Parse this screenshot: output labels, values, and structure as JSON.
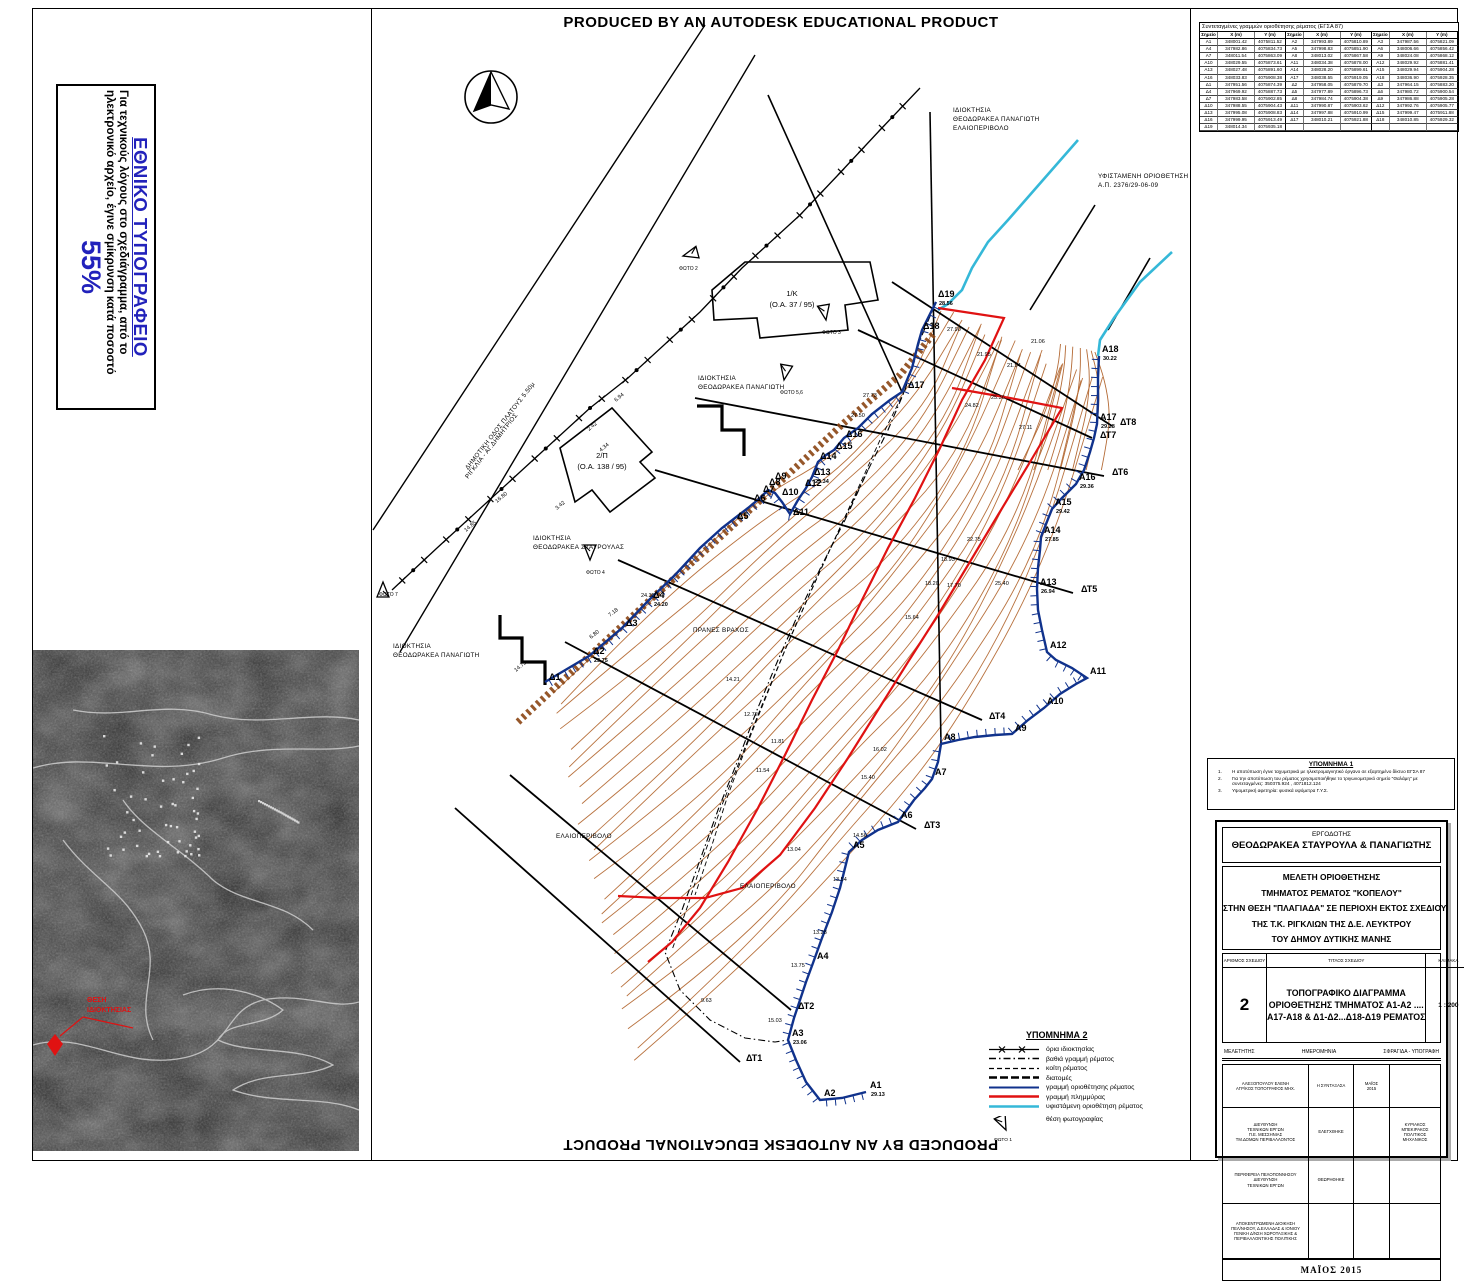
{
  "banner": {
    "text": "PRODUCED BY AN AUTODESK EDUCATIONAL PRODUCT"
  },
  "disclaimer": {
    "title": "ΕΘΝΙΚΟ ΤΥΠΟΓΡΑΦΕΙΟ",
    "body": "Για τεχνικούς λόγους στο σχεδιάγραμμα, από το ηλεκτρονικό αρχείο, έγινε σμίκρυνση κατά ποσοστό",
    "percent": "55%"
  },
  "north": {
    "label": "Β"
  },
  "aerial": {
    "label1": "ΘΕΣΗ",
    "label2": "ΙΔΙΟΚΤΗΣΙΑΣ"
  },
  "coords_table": {
    "title": "Συντεταγμένες γραμμών οριοθέτησης ρέματος (ΕΓΣΑ 87)",
    "headers": [
      "Σημείο",
      "X (m)",
      "Y (m)",
      "Σημείο",
      "X (m)",
      "Y (m)",
      "Σημείο",
      "X (m)",
      "Y (m)"
    ],
    "rows": [
      [
        "Α1",
        "348001.42",
        "4075811.52",
        "Α2",
        "347993.89",
        "4075810.89",
        "Α3",
        "347987.56",
        "4075821.09"
      ],
      [
        "Α4",
        "347982.86",
        "4075834.73",
        "Α5",
        "347998.83",
        "4075851.90",
        "Α6",
        "348006.66",
        "4075856.42"
      ],
      [
        "Α7",
        "348011.54",
        "4075863.09",
        "Α8",
        "348013.02",
        "4075867.58",
        "Α9",
        "348024.08",
        "4075868.12"
      ],
      [
        "Α10",
        "348029.55",
        "4075873.61",
        "Α11",
        "348034.38",
        "4075878.00",
        "Α12",
        "348029.92",
        "4075881.41"
      ],
      [
        "Α13",
        "348027.48",
        "4075891.60",
        "Α14",
        "348028.20",
        "4075899.61",
        "Α15",
        "348029.94",
        "4075904.28"
      ],
      [
        "Α16",
        "348033.83",
        "4075908.38",
        "Α17",
        "348038.55",
        "4075919.05",
        "Α18",
        "348036.90",
        "4075928.35"
      ],
      [
        "Δ1",
        "347951.56",
        "4075874.39",
        "Δ2",
        "347958.05",
        "4075879.70",
        "Δ3",
        "347964.15",
        "4075883.20"
      ],
      [
        "Δ4",
        "347969.92",
        "4075887.73",
        "Δ5",
        "347977.89",
        "4075896.73",
        "Δ6",
        "347980.72",
        "4075900.54"
      ],
      [
        "Δ7",
        "347983.58",
        "4075902.85",
        "Δ8",
        "347984.74",
        "4075904.38",
        "Δ9",
        "347986.88",
        "4075905.28"
      ],
      [
        "Δ10",
        "347988.55",
        "4075904.43",
        "Δ11",
        "347990.87",
        "4075903.62",
        "Δ12",
        "347992.76",
        "4075905.77"
      ],
      [
        "Δ13",
        "347995.08",
        "4075908.83",
        "Δ14",
        "347997.88",
        "4075910.99",
        "Δ15",
        "347999.47",
        "4075911.88"
      ],
      [
        "Δ16",
        "347999.95",
        "4075913.49",
        "Δ17",
        "348010.21",
        "4075921.88",
        "Δ18",
        "348010.85",
        "4075929.32"
      ],
      [
        "Δ19",
        "348014.34",
        "4075935.18",
        "",
        "",
        "",
        "",
        "",
        ""
      ]
    ]
  },
  "note1": {
    "title": "ΥΠΟΜΝΗΜΑ 1",
    "items": [
      "Η αποτύπωση έγινε ταχυμετρικά με ηλεκτρομαγνητικό όργανο σε εξαρτημένο δίκτυο ΕΓΣΑ 87",
      "Για την αποτύπωση του ρέματος χρησιμοποιήθηκε το  τριγωνομετρικό σημείο \"Θαλάμη\" με συντεταγμένες:  350375.924 , 4071812.124",
      "Υψομετρική αφετηρία: φυσικά υψόμετρα Γ.Υ.Σ."
    ]
  },
  "legend": {
    "title": "ΥΠΟΜΝΗΜΑ 2",
    "items": [
      {
        "key": "boundary",
        "label": "όρια ιδιοκτησίας"
      },
      {
        "key": "deep",
        "label": "βαθιά γραμμή ρέματος"
      },
      {
        "key": "bed",
        "label": "κοίτη ρέματος"
      },
      {
        "key": "sections",
        "label": "διατομές"
      },
      {
        "key": "delimit",
        "label": "γραμμή οριοθέτησης ρέματος"
      },
      {
        "key": "flood",
        "label": "γραμμή πλημμύρας"
      },
      {
        "key": "existing",
        "label": "υφιστάμενη οριοθέτηση ρέματος"
      },
      {
        "key": "photo",
        "label": "θέση φωτογραφίας"
      }
    ],
    "photo_label": "ΦΩΤΟ 1"
  },
  "titleblock": {
    "employer_heading": "ΕΡΓΟΔΟΤΗΣ",
    "employer": "ΘΕΟΔΩΡΑΚΕΑ ΣΤΑΥΡΟΥΛΑ & ΠΑΝΑΓΙΩΤΗΣ",
    "study_lines": [
      "ΜΕΛΕΤΗ  ΟΡΙΟΘΕΤΗΣΗΣ",
      "ΤΜΗΜΑΤΟΣ ΡΕΜΑΤΟΣ \"ΚΟΠΕΛΟΥ\"",
      "ΣΤΗΝ ΘΕΣΗ \"ΠΛΑΓΙΑΔΑ\" ΣΕ ΠΕΡΙΟΧΗ ΕΚΤΟΣ ΣΧΕΔΙΟΥ",
      "ΤΗΣ Τ.Κ. ΡΙΓΚΛΙΩΝ ΤΗΣ Δ.Ε. ΛΕΥΚΤΡΟΥ",
      "ΤΟΥ ΔΗΜΟΥ ΔΥΤΙΚΗΣ ΜΑΝΗΣ"
    ],
    "num_header": "ΑΡΙΘΜΟΣ ΣΧΕΔΙΟΥ",
    "title_header": "ΤΙΤΛΟΣ ΣΧΕΔΙΟΥ",
    "scale_header": "ΚΛΙΜΑΚΑ",
    "number": "2",
    "drawing_title_lines": [
      "ΤΟΠΟΓΡΑΦΙΚΟ ΔΙΑΓΡΑΜΜΑ",
      "ΟΡΙΟΘΕΤΗΣΗΣ ΤΜΗΜΑΤΟΣ Α1-Α2 ....",
      "Α17-Α18 & Δ1-Δ2...Δ18-Δ19 ΡΕΜΑΤΟΣ"
    ],
    "scale": "1 : 200",
    "roles": {
      "melet": "ΜΕΛΕΤΗΤΗΣ",
      "date": "ΗΜΕΡΟΜΗΝΙΑ",
      "sig": "ΣΦΡΑΓΙΔΑ   -   ΥΠΟΓΡΑΦΗ"
    },
    "sig_rows": [
      {
        "who": [
          "ΑΛΕΞΟΠΟΥΛΟΥ ΕΛΕΝΗ",
          "ΑΓΡ/ΚΟΣ ΤΟΠΟΓΡΑΦΟΣ ΜΗΧ."
        ],
        "role": "Η ΣΥΝΤΑΞΑΣΑ",
        "date": [
          "ΜΑΪΟΣ",
          "2015"
        ],
        "sig": []
      },
      {
        "who": [
          "ΔΙΕΥΘΥΝΣΗ",
          "ΤΕΧΝΙΚΩΝ ΕΡΓΩΝ",
          "Π.Ε. ΜΕΣΣΗΝΙΑΣ",
          "ΤΜ.ΔΟΜΩΝ ΠΕΡΙΒΑΛΛΟΝΤΟΣ"
        ],
        "role": "ΕΛΕΓΧΘΗΚΕ",
        "date": [],
        "sig": [
          "ΚΥΡΙΑΚΟΣ ΜΠΕΚΙΡΑΚΟΣ",
          "ΠΟΛΙΤΙΚΟΣ ΜΗΧΑΝΙΚΟΣ"
        ]
      },
      {
        "who": [
          "ΠΕΡΙΦΕΡΕΙΑ ΠΕΛΟΠΟΝΝΗΣΟΥ",
          "ΔΙΕΥΘΥΝΣΗ",
          "ΤΕΧΝΙΚΩΝ ΕΡΓΩΝ"
        ],
        "role": "ΘΕΩΡΗΘΗΚΕ",
        "date": [],
        "sig": []
      },
      {
        "who": [
          "ΑΠΟΚΕΝΤΡΩΜΕΝΗ ΔΙΟΙΚΗΣΗ",
          "ΠΕΛ/ΝΗΣΟΥ, Δ.ΕΛΛΑΔΑΣ & ΙΟΝΙΟΥ",
          "ΓΕΝΙΚΗ Δ/ΝΣΗ ΧΩΡΟΤΑΞΙΚΗΣ &",
          "ΠΕΡΙΒΑΛΛΟΝΤΙΚΗΣ ΠΟΛΙΤΙΚΗΣ"
        ],
        "role": "",
        "date": [],
        "sig": []
      }
    ],
    "footer_date": "ΜΑΪΟΣ 2015"
  },
  "map": {
    "colors": {
      "contour": "#b46a35",
      "delimit": "#10328c",
      "flood": "#e01212",
      "existing": "#35b8d8",
      "band": "#8b4513"
    },
    "points": [
      [
        "Δ1",
        545,
        682,
        ""
      ],
      [
        "Δ2",
        589,
        656,
        "23.75"
      ],
      [
        "Δ3",
        622,
        628,
        ""
      ],
      [
        "Δ4",
        649,
        600,
        "24.20"
      ],
      [
        "Δ5",
        733,
        521,
        ""
      ],
      [
        "Δ6",
        750,
        503,
        ""
      ],
      [
        "Δ7",
        759,
        494,
        ""
      ],
      [
        "Δ8",
        765,
        487,
        ""
      ],
      [
        "Δ9",
        771,
        481,
        ""
      ],
      [
        "Δ10",
        778,
        497,
        ""
      ],
      [
        "Δ11",
        789,
        517,
        ""
      ],
      [
        "Δ12",
        801,
        488,
        ""
      ],
      [
        "Δ13",
        810,
        477,
        "25.34"
      ],
      [
        "Δ14",
        816,
        461,
        ""
      ],
      [
        "Δ15",
        832,
        451,
        ""
      ],
      [
        "Δ16",
        842,
        439,
        ""
      ],
      [
        "Δ17",
        904,
        390,
        ""
      ],
      [
        "Δ18",
        919,
        331,
        ""
      ],
      [
        "Δ19",
        934,
        299,
        "28.56"
      ],
      [
        "Α1",
        866,
        1090,
        "29.13"
      ],
      [
        "Α2",
        820,
        1098,
        ""
      ],
      [
        "Α3",
        788,
        1038,
        "23.06"
      ],
      [
        "Α4",
        813,
        961,
        ""
      ],
      [
        "Α5",
        849,
        850,
        ""
      ],
      [
        "Α6",
        897,
        820,
        ""
      ],
      [
        "Α7",
        931,
        777,
        ""
      ],
      [
        "Α8",
        940,
        742,
        ""
      ],
      [
        "Α9",
        1011,
        733,
        ""
      ],
      [
        "Α10",
        1043,
        706,
        ""
      ],
      [
        "Α11",
        1086,
        676,
        ""
      ],
      [
        "Α12",
        1046,
        650,
        ""
      ],
      [
        "Α13",
        1036,
        587,
        "26.94"
      ],
      [
        "Α14",
        1040,
        535,
        "27.85"
      ],
      [
        "Α15",
        1051,
        507,
        "29.42"
      ],
      [
        "Α16",
        1075,
        482,
        "29.36"
      ],
      [
        "Α17",
        1096,
        422,
        "29.28"
      ],
      [
        "Α18",
        1098,
        354,
        "30.22"
      ],
      [
        "ΔΤ1",
        742,
        1063,
        ""
      ],
      [
        "ΔΤ2",
        794,
        1011,
        ""
      ],
      [
        "ΔΤ3",
        920,
        830,
        ""
      ],
      [
        "ΔΤ4",
        985,
        721,
        ""
      ],
      [
        "ΔΤ5",
        1077,
        594,
        ""
      ],
      [
        "ΔΤ6",
        1108,
        477,
        ""
      ],
      [
        "ΔΤ7",
        1096,
        440,
        ""
      ],
      [
        "ΔΤ8",
        1116,
        427,
        ""
      ]
    ],
    "areas": [
      {
        "lines": [
          "ΙΔΙΟΚΤΗΣΙΑ",
          "ΘΕΟΔΩΡΑΚΕΑ ΠΑΝΑΓΙΩΤΗ",
          "ΕΛΑΙΟΠΕΡΙΒΟΛΟ"
        ],
        "x": 953,
        "y": 112,
        "rot": 0
      },
      {
        "lines": [
          "ΥΦΙΣΤΑΜΕΝΗ ΟΡΙΟΘΕΤΗΣΗ",
          "Α.Π. 2376/29-06-09"
        ],
        "x": 1098,
        "y": 178,
        "rot": 0
      },
      {
        "lines": [
          "ΙΔΙΟΚΤΗΣΙΑ",
          "ΘΕΟΔΩΡΑΚΕΑ ΠΑΝΑΓΙΩΤΗ"
        ],
        "x": 698,
        "y": 380,
        "rot": 0
      },
      {
        "lines": [
          "ΙΔΙΟΚΤΗΣΙΑ",
          "ΘΕΟΔΩΡΑΚΕΑ ΣΤΑΥΡΟΥΛΑΣ"
        ],
        "x": 533,
        "y": 540,
        "rot": 0
      },
      {
        "lines": [
          "ΙΔΙΟΚΤΗΣΙΑ",
          "ΘΕΟΔΩΡΑΚΕΑ ΠΑΝΑΓΙΩΤΗ"
        ],
        "x": 393,
        "y": 648,
        "rot": 0
      },
      {
        "lines": [
          "ΕΛΑΙΟΠΕΡΙΒΟΛΟ"
        ],
        "x": 556,
        "y": 838,
        "rot": 0
      },
      {
        "lines": [
          "ΕΛΑΙΟΠΕΡΙΒΟΛΟ"
        ],
        "x": 740,
        "y": 888,
        "rot": 0
      },
      {
        "lines": [
          "ΠΡΑΝΕΣ ΒΡΑΧΟΣ"
        ],
        "x": 693,
        "y": 632,
        "rot": 0
      },
      {
        "lines": [
          "ΔΗΜΟΤΙΚΗ ΟΔΟΣ ΠΛΑΤΟΥΣ 5.50μ",
          "ΡΙΓΚΛΙΑ - ΑΓ.ΔΗΜΗΤΡΙΟΣ"
        ],
        "x": 468,
        "y": 470,
        "rot": -52
      }
    ],
    "buildings": [
      {
        "label1": "1/Κ",
        "label2": "(Ο.Α. 37 / 95)",
        "x": 792,
        "y": 296
      },
      {
        "label1": "2/Π",
        "label2": "(Ο.Α. 138 / 95)",
        "x": 602,
        "y": 458
      }
    ],
    "photos": [
      {
        "label": "ΦΩΤΟ 2",
        "x": 683,
        "y": 256,
        "rot": -15
      },
      {
        "label": "ΦΩΤΟ 3",
        "x": 826,
        "y": 320,
        "rot": -100
      },
      {
        "label": "ΦΩΤΟ 5,6",
        "x": 784,
        "y": 380,
        "rot": -80
      },
      {
        "label": "ΦΩΤΟ 4",
        "x": 590,
        "y": 560,
        "rot": -90
      },
      {
        "label": "ΦΩΤΟ 7",
        "x": 383,
        "y": 582,
        "rot": 90
      }
    ],
    "measures": [
      [
        "14.75",
        516,
        672,
        -40
      ],
      [
        "14.85",
        466,
        532,
        -40
      ],
      [
        "16.80",
        497,
        503,
        -40
      ],
      [
        "3.42",
        557,
        510,
        -40
      ],
      [
        "2.42",
        589,
        431,
        -40
      ],
      [
        "6.94",
        616,
        402,
        -40
      ],
      [
        "4.34",
        601,
        452,
        -40
      ],
      [
        "6.80",
        591,
        639,
        -38
      ],
      [
        "7.18",
        610,
        617,
        -38
      ],
      [
        "24.35",
        641,
        597,
        0
      ],
      [
        "15.03",
        768,
        1022,
        0
      ],
      [
        "9.63",
        701,
        1002,
        0
      ],
      [
        "13.75",
        791,
        967,
        0
      ],
      [
        "13.28",
        813,
        934,
        0
      ],
      [
        "13.54",
        833,
        881,
        0
      ],
      [
        "13.04",
        787,
        851,
        0
      ],
      [
        "14.56",
        853,
        837,
        0
      ],
      [
        "11.54",
        756,
        772,
        0
      ],
      [
        "11.81",
        771,
        743,
        0
      ],
      [
        "12.72",
        744,
        716,
        0
      ],
      [
        "14.21",
        726,
        681,
        0
      ],
      [
        "15.40",
        861,
        779,
        0
      ],
      [
        "16.02",
        873,
        751,
        0
      ],
      [
        "15.64",
        905,
        619,
        0
      ],
      [
        "17.70",
        947,
        587,
        0
      ],
      [
        "18.20",
        925,
        585,
        0
      ],
      [
        "18.93",
        941,
        561,
        0
      ],
      [
        "22.75",
        967,
        541,
        0
      ],
      [
        "25.40",
        995,
        585,
        0
      ],
      [
        "21.95",
        977,
        356,
        0
      ],
      [
        "21.94",
        1007,
        367,
        0
      ],
      [
        "21.06",
        1031,
        343,
        0
      ],
      [
        "27.90",
        947,
        331,
        0
      ],
      [
        "25.36",
        991,
        399,
        0
      ],
      [
        "24.82",
        965,
        407,
        0
      ],
      [
        "27.11",
        1019,
        429,
        0
      ],
      [
        "27.73",
        863,
        397,
        0
      ],
      [
        "27.50",
        851,
        417,
        0
      ]
    ]
  }
}
